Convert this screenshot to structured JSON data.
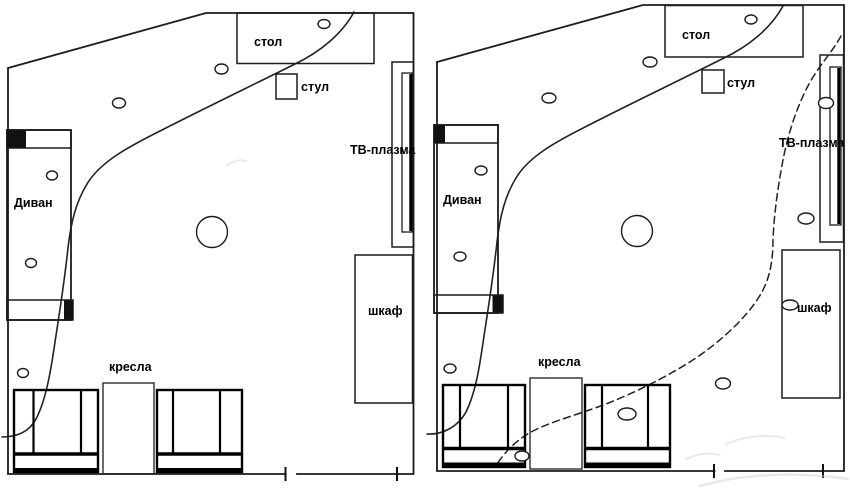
{
  "colors": {
    "background": "#ffffff",
    "line": "#1c1c1c",
    "furniture_outline": "#000000",
    "text": "#000000"
  },
  "plans": [
    {
      "id": "left-plan",
      "labels": {
        "desk": "стол",
        "chair": "стул",
        "tv": "ТВ-плазма",
        "sofa": "Диван",
        "armchairs": "кресла",
        "cabinet": "шкаф"
      }
    },
    {
      "id": "right-plan",
      "labels": {
        "desk": "стол",
        "chair": "стул",
        "tv": "ТВ-плазма",
        "sofa": "Диван",
        "armchairs": "кресла",
        "cabinet": "шкаф"
      }
    }
  ]
}
